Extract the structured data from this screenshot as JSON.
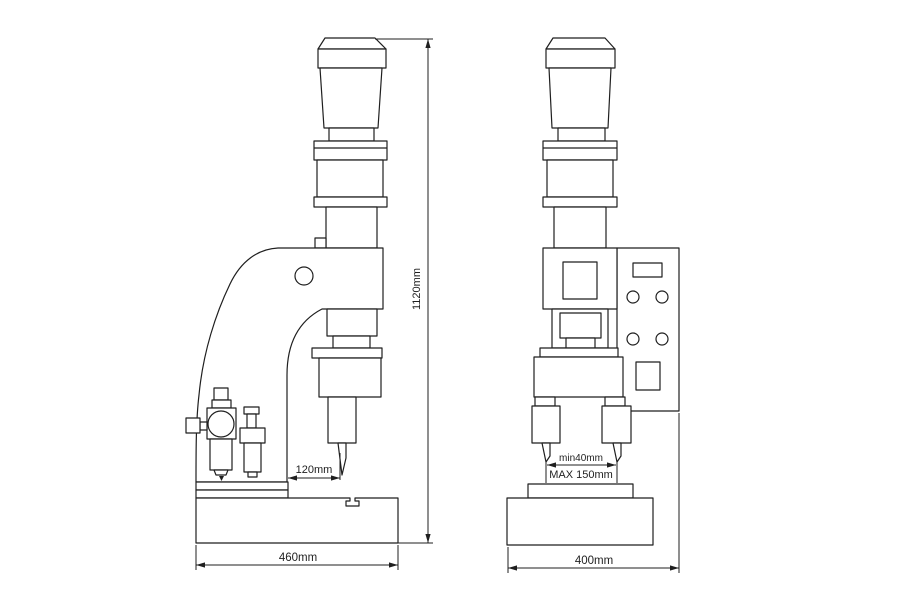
{
  "page": {
    "background_color": "#ffffff",
    "line_color": "#1f1f1f"
  },
  "drawing": {
    "subject": "pneumatic-press-two-view-technical-drawing",
    "views": {
      "side": {
        "dimensions": {
          "overall_height": "1120mm",
          "throat_depth": "120mm",
          "base_width": "460mm"
        }
      },
      "front": {
        "dimensions": {
          "tool_gap_min": "min40mm",
          "tool_gap_max": "MAX 150mm",
          "base_width": "400mm"
        }
      }
    }
  }
}
